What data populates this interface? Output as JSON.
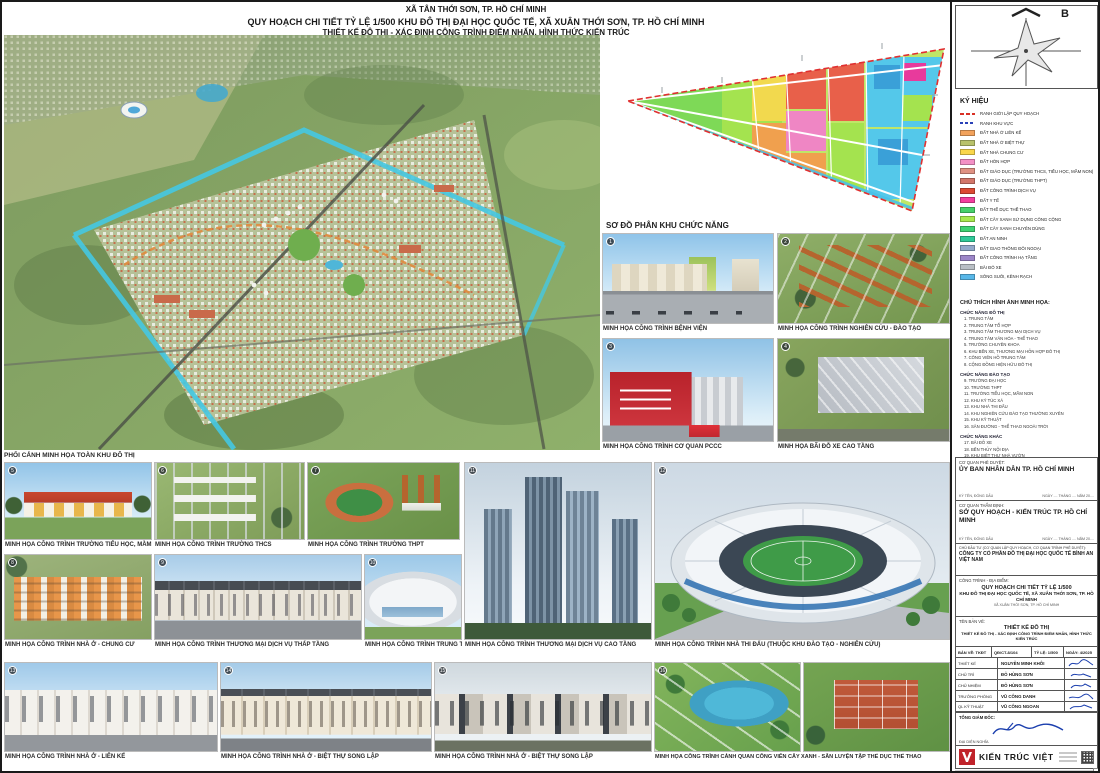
{
  "header": {
    "line1": "XÃ TÂN THỚI SƠN, TP. HỒ CHÍ MINH",
    "line2": "QUY HOẠCH CHI TIẾT TỶ LỆ 1/500 KHU ĐÔ THỊ ĐẠI HỌC QUỐC TẾ, XÃ XUÂN THỚI SƠN, TP. HỒ CHÍ MINH",
    "line3": "THIẾT KẾ ĐÔ THỊ - XÁC ĐỊNH CÔNG TRÌNH ĐIỂM NHẤN, HÌNH THỨC KIẾN TRÚC"
  },
  "compass": {
    "north_label": "B"
  },
  "master_plan": {
    "caption": "PHỐI CẢNH MINH HỌA TOÀN KHU ĐÔ THỊ"
  },
  "functional_diagram": {
    "title": "SƠ ĐỒ PHÂN KHU CHỨC NĂNG"
  },
  "legend": {
    "title": "KÝ HIỆU",
    "boundary_items": [
      {
        "label": "RANH GIỚI LẬP QUY HOẠCH",
        "color": "#D93025"
      },
      {
        "label": "RANH KHU VỰC",
        "color": "#2A41B8"
      }
    ],
    "items": [
      {
        "label": "ĐẤT NHÀ Ở LIÊN KẾ",
        "color": "#F2A25C"
      },
      {
        "label": "ĐẤT NHÀ Ở BIỆT THỰ",
        "color": "#B9C26B"
      },
      {
        "label": "ĐẤT NHÀ CHUNG CƯ",
        "color": "#F9D64B"
      },
      {
        "label": "ĐẤT HỖN HỢP",
        "color": "#F390C6"
      },
      {
        "label": "ĐẤT GIÁO DỤC (TRƯỜNG THCS, TIỂU HỌC, MẦM NON)",
        "color": "#DF9183"
      },
      {
        "label": "ĐẤT GIÁO DỤC (TRƯỜNG THPT)",
        "color": "#D2766A"
      },
      {
        "label": "ĐẤT CÔNG TRÌNH DỊCH VỤ",
        "color": "#DC4A33"
      },
      {
        "label": "ĐẤT Y TẾ",
        "color": "#F23F9E"
      },
      {
        "label": "ĐẤT THỂ DỤC THỂ THAO",
        "color": "#46D06A"
      },
      {
        "label": "ĐẤT CÂY XANH SỬ DỤNG CÔNG CỘNG",
        "color": "#A8E84F"
      },
      {
        "label": "ĐẤT CÂY XANH CHUYÊN DÙNG",
        "color": "#3ED273"
      },
      {
        "label": "ĐẤT AN NINH",
        "color": "#2FC998"
      },
      {
        "label": "ĐẤT GIAO THÔNG ĐỐI NGOẠI",
        "color": "#92A9CB"
      },
      {
        "label": "ĐẤT CÔNG TRÌNH HẠ TẦNG",
        "color": "#9C86C8"
      },
      {
        "label": "BÃI ĐỖ XE",
        "color": "#B9BFC5"
      },
      {
        "label": "SÔNG SUỐI, KÊNH RẠCH",
        "color": "#58B7E8"
      }
    ]
  },
  "notes": {
    "title": "CHÚ THÍCH HÌNH ẢNH MINH HỌA:",
    "groups": [
      {
        "title": "CHỨC NĂNG ĐÔ THỊ",
        "items_text": "1. TRUNG TÂM\n2. TRUNG TÂM TỔ HỢP\n3. TRUNG TÂM THƯƠNG MẠI DỊCH VỤ\n4. TRUNG TÂM VĂN HÓA - THỂ THAO\n5. TRƯỜNG CHUYÊN KHOA\n6. KHU BẾN XE, THƯƠNG MẠI HỖN HỢP ĐÔ THỊ\n7. CÔNG VIÊN HỒ TRUNG TÂM\n8. CỘNG ĐỒNG HIỆN HỮU ĐÔ THỊ"
      },
      {
        "title": "CHỨC NĂNG ĐÀO TẠO",
        "items_text": "9. TRƯỜNG ĐẠI HỌC\n10. TRƯỜNG THPT\n11. TRƯỜNG TIỂU HỌC, MẦM NON\n12. KHU KÝ TÚC XÁ\n13. KHU NHÀ THI ĐẤU\n14. KHU NGHIÊN CỨU ĐÀO TẠO THƯỜNG XUYÊN\n15. KHU KỸ THUẬT\n16. SÂN ĐƯỜNG - THỂ THAO NGOÀI TRỜI"
      },
      {
        "title": "CHỨC NĂNG KHÁC",
        "items_text": "17. BÃI ĐỖ XE\n18. BẾN THỦY NỘI ĐỊA\n19. KHU BIỆT THỰ NHÀ VƯỜN\n20. CHUNG CƯ"
      }
    ]
  },
  "photos": [
    {
      "num": "1",
      "caption": "MINH HỌA CÔNG TRÌNH BỆNH VIỆN"
    },
    {
      "num": "2",
      "caption": "MINH HỌA CÔNG TRÌNH NGHIÊN CỨU - ĐÀO TẠO"
    },
    {
      "num": "3",
      "caption": "MINH HỌA CÔNG TRÌNH CƠ QUAN PCCC"
    },
    {
      "num": "4",
      "caption": "MINH HỌA BÃI ĐỖ XE CAO TẦNG"
    },
    {
      "num": "5",
      "caption": "MINH HỌA CÔNG TRÌNH TRƯỜNG TIỂU HỌC, MẦM NON"
    },
    {
      "num": "6",
      "caption": "MINH HỌA CÔNG TRÌNH TRƯỜNG THCS"
    },
    {
      "num": "7",
      "caption": "MINH HỌA CÔNG TRÌNH TRƯỜNG THPT"
    },
    {
      "num": "8",
      "caption": "MINH HỌA CÔNG TRÌNH NHÀ Ở - CHUNG CƯ"
    },
    {
      "num": "9",
      "caption": "MINH HỌA CÔNG TRÌNH THƯƠNG MẠI DỊCH VỤ THẤP TẦNG"
    },
    {
      "num": "10",
      "caption": "MINH HỌA CÔNG TRÌNH TRUNG TÂM THƯƠNG MẠI"
    },
    {
      "num": "11",
      "caption": "MINH HỌA CÔNG TRÌNH THƯƠNG MẠI DỊCH VỤ CAO TẦNG"
    },
    {
      "num": "12",
      "caption": "MINH HỌA CÔNG TRÌNH NHÀ THI ĐẤU (THUỘC KHU ĐÀO TẠO - NGHIÊN CỨU)"
    },
    {
      "num": "13",
      "caption": "MINH HỌA CÔNG TRÌNH NHÀ Ở - LIÊN KẾ"
    },
    {
      "num": "14",
      "caption": "MINH HỌA CÔNG TRÌNH NHÀ Ở - BIỆT THỰ SONG LẬP"
    },
    {
      "num": "15",
      "caption": "MINH HỌA CÔNG TRÌNH NHÀ Ở - BIỆT THỰ SONG LẬP"
    },
    {
      "num": "16",
      "caption": "MINH HỌA CÔNG TRÌNH CẢNH QUAN CÔNG VIÊN CÂY XANH - SÂN LUYỆN TẬP THỂ DỤC THỂ THAO"
    }
  ],
  "approval": {
    "block1": {
      "label": "CƠ QUAN PHÊ DUYỆT:",
      "name": "ỦY BAN NHÂN DÂN TP. HỒ CHÍ MINH",
      "sign_note": "KÝ TÊN, ĐÓNG DẤU",
      "date_note": "NGÀY .... THÁNG .... NĂM 20...."
    },
    "block2": {
      "label": "CƠ QUAN THẨM ĐỊNH:",
      "name": "SỞ QUY HOẠCH - KIẾN TRÚC TP. HỒ CHÍ MINH",
      "sign_note": "KÝ TÊN, ĐÓNG DẤU",
      "date_note": "NGÀY .... THÁNG .... NĂM 20...."
    },
    "block3": {
      "label": "CHỦ ĐẦU TƯ (CƠ QUAN LẬP QUY HOẠCH, CƠ QUAN TRÌNH PHÊ DUYỆT):",
      "name": "CÔNG TY CỔ PHẦN ĐÔ THỊ ĐẠI HỌC QUỐC TẾ BÌNH AN VIỆT NAM"
    }
  },
  "titleblock": {
    "project_label": "CÔNG TRÌNH - ĐỊA ĐIỂM:",
    "project_line1": "QUY HOẠCH CHI TIẾT TỶ LỆ 1/500",
    "project_line2": "KHU ĐÔ THỊ ĐẠI HỌC QUỐC TẾ, XÃ XUÂN THỚI SƠN, TP. HỒ CHÍ MINH",
    "project_line3": "XÃ XUÂN THỚI SƠN, TP. HỒ CHÍ MINH",
    "drawing_label": "TÊN BẢN VẼ:",
    "drawing_line1": "THIẾT KẾ ĐÔ THỊ",
    "drawing_line2": "THIẾT KẾ ĐÔ THỊ - XÁC ĐỊNH CÔNG TRÌNH ĐIỂM NHẤN, HÌNH THỨC KIẾN TRÚC",
    "meta": {
      "sheet": "BẢN VẼ: TKĐT",
      "code": "QĐ/CT-8/104",
      "scale": "TỶ LỆ: 1/500",
      "date": "NGÀY: 4/2025"
    },
    "rows": [
      {
        "role": "THIẾT KẾ",
        "name": "NGUYỄN MINH KHÔI"
      },
      {
        "role": "CHỦ TRÌ",
        "name": "ĐỖ HÙNG SƠN"
      },
      {
        "role": "CHỦ NHIỆM",
        "name": "ĐỖ HÙNG SƠN"
      },
      {
        "role": "TRƯỞNG PHÒNG",
        "name": "VŨ CÔNG DANH"
      },
      {
        "role": "QL KỸ THUẬT",
        "name": "VŨ CÔNG NGOAN"
      }
    ],
    "director_label": "TỔNG GIÁM ĐỐC:",
    "director_name": "ĐẠI DIỆN NGHĨA"
  },
  "firm": {
    "name": "KIẾN TRÚC VIỆT"
  }
}
